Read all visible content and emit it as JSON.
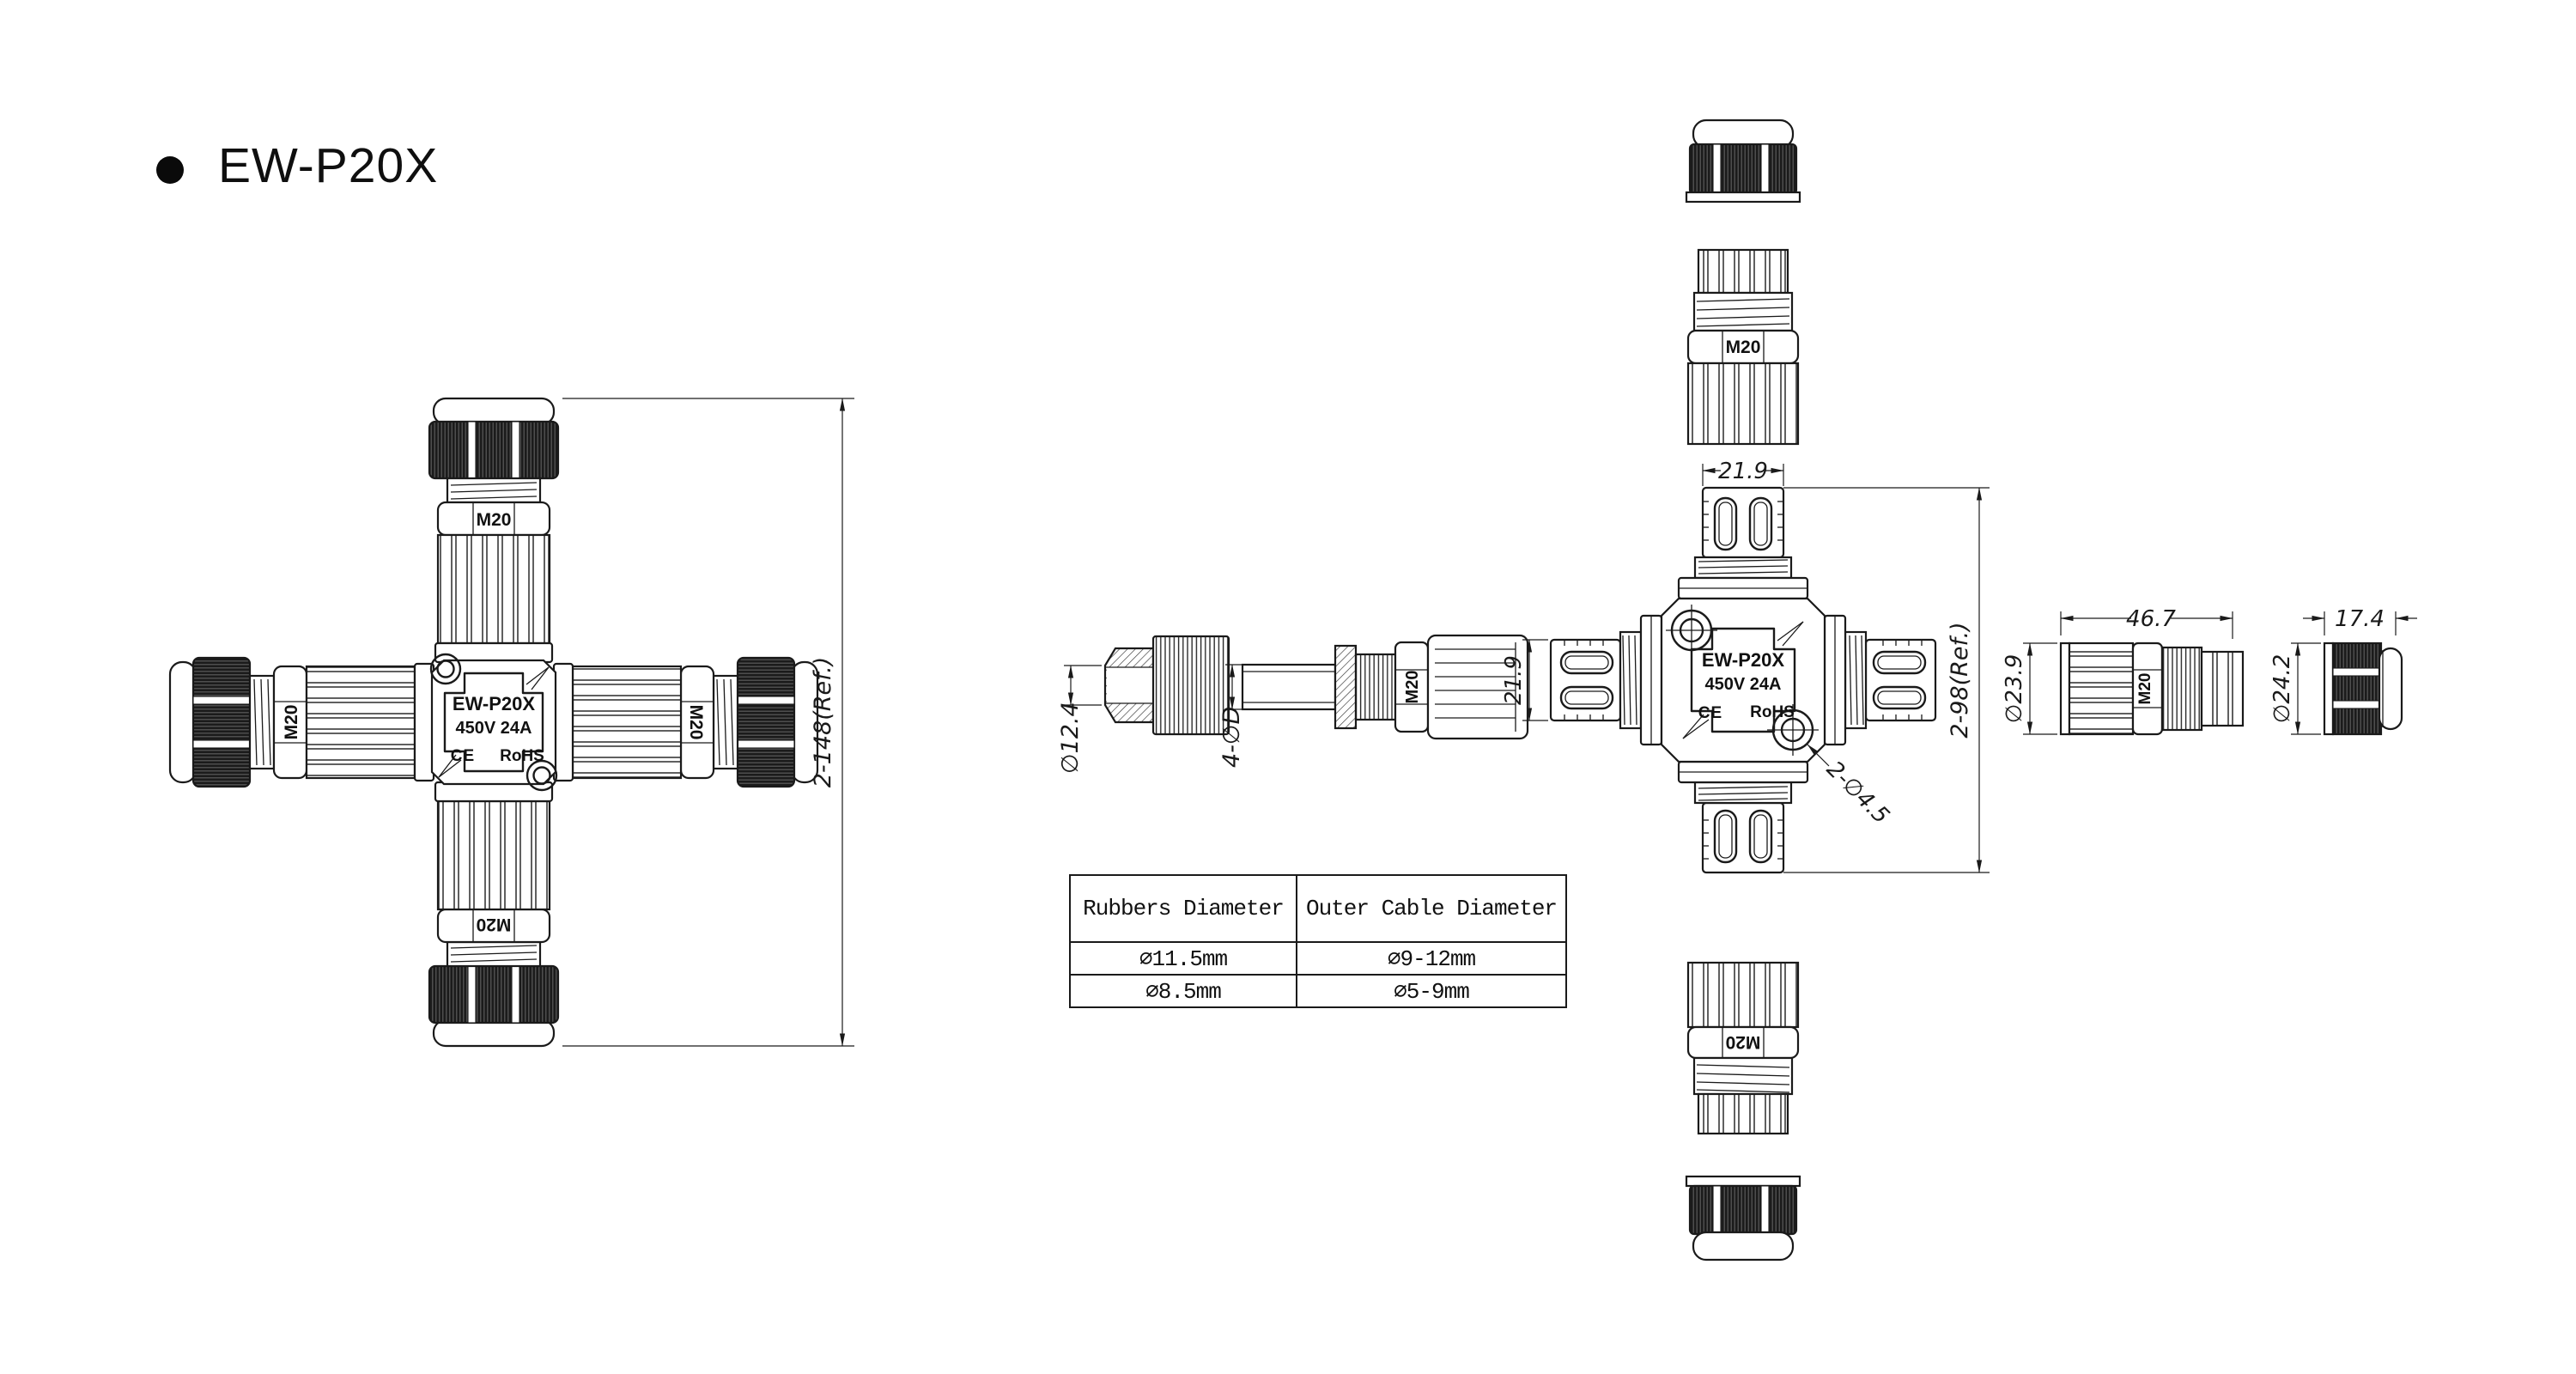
{
  "title": "EW-P20X",
  "labels": {
    "m20": "M20",
    "model": "EW-P20X",
    "rating": "450V 24A",
    "ce": "CE",
    "rohs": "RoHS"
  },
  "dimensions": {
    "assembled_span": "2-148(Ref.)",
    "seal_diameter": "∅12.4",
    "gland_holes": "4-∅D",
    "arm_width_top": "21.9",
    "arm_width_left": "21.9",
    "body_span": "2-98(Ref.)",
    "screw_holes": "2-∅4.5",
    "gland_length": "46.7",
    "gland_diameter": "∅23.9",
    "cap_length": "17.4",
    "cap_diameter": "∅24.2"
  },
  "table": {
    "headers": [
      "Rubbers Diameter",
      "Outer Cable Diameter"
    ],
    "rows": [
      [
        "∅11.5mm",
        "∅9-12mm"
      ],
      [
        "∅8.5mm",
        "∅5-9mm"
      ]
    ]
  }
}
